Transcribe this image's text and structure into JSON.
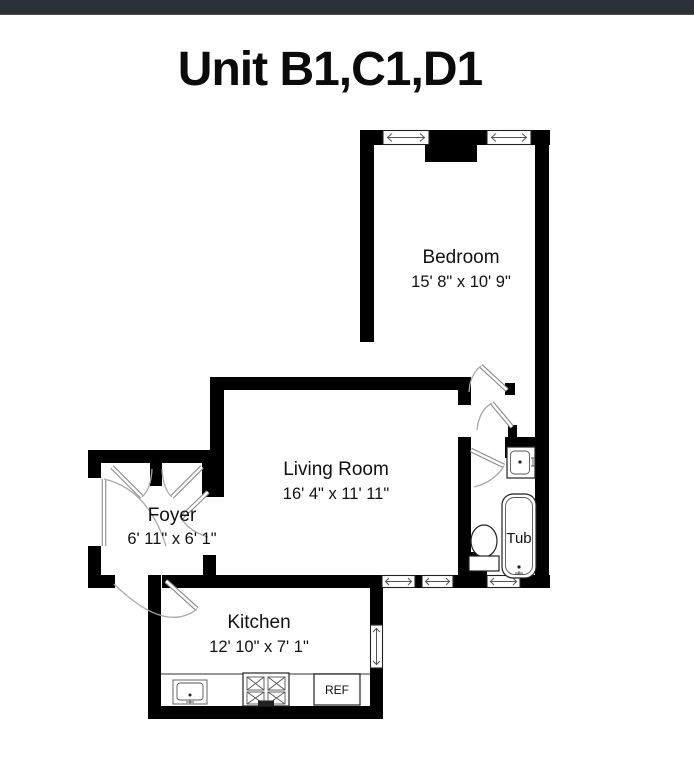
{
  "meta": {
    "background_color": "#ffffff",
    "wall_color": "#000000",
    "top_bar_color": "#2c3037"
  },
  "title": "Unit B1,C1,D1",
  "rooms": [
    {
      "id": "bedroom",
      "name": "Bedroom",
      "dimensions": "15' 8\" x 10' 9\""
    },
    {
      "id": "living-room",
      "name": "Living Room",
      "dimensions": "16' 4\" x 11' 11\""
    },
    {
      "id": "foyer",
      "name": "Foyer",
      "dimensions": "6' 11\" x 6' 1\""
    },
    {
      "id": "kitchen",
      "name": "Kitchen",
      "dimensions": "12' 10\" x 7' 1\""
    }
  ],
  "fixture_labels": {
    "tub": "Tub",
    "refrigerator": "REF"
  }
}
